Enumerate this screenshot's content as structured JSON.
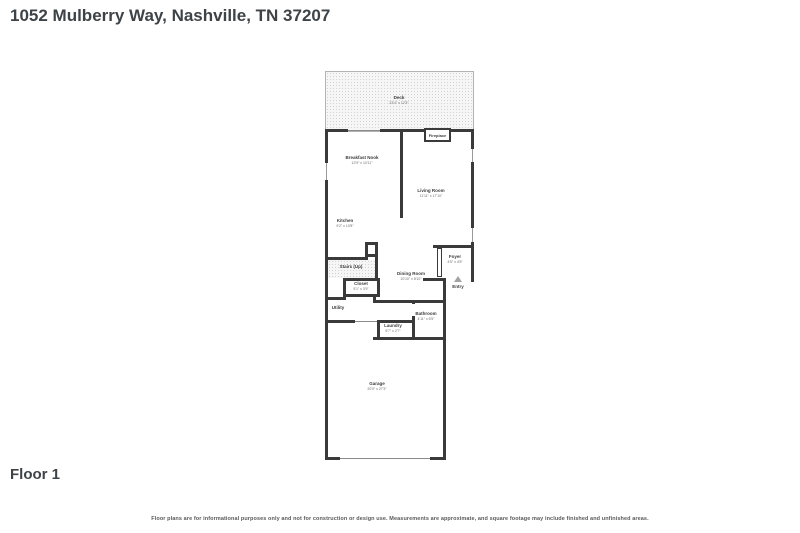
{
  "title": "1052 Mulberry Way, Nashville, TN 37207",
  "floor_label": "Floor 1",
  "disclaimer": "Floor plans are for informational purposes only and not for construction or design use. Measurements are approximate, and square footage may include finished and unfinished areas.",
  "colors": {
    "wall": "#3a3a3a",
    "title_text": "#3e4347",
    "dims_text": "#6b6b6b",
    "entry_marker": "#a3a3a3"
  },
  "rooms": {
    "deck": {
      "name": "Deck",
      "dims": "23'4\" x 12'3\""
    },
    "breakfast_nook": {
      "name": "Breakfast Nook",
      "dims": "12'9\" x 10'11\""
    },
    "living_room": {
      "name": "Living Room",
      "dims": "11'11\" x 17'10\""
    },
    "kitchen": {
      "name": "Kitchen",
      "dims": "9'2\" x 10'8\""
    },
    "stairs": {
      "name": "Stairs (Up)",
      "dims": ""
    },
    "closet": {
      "name": "Closet",
      "dims": "5'1\" x 3'9\""
    },
    "utility": {
      "name": "Utility",
      "dims": ""
    },
    "dining_room": {
      "name": "Dining Room",
      "dims": "10'10\" x 8'10\""
    },
    "foyer": {
      "name": "Foyer",
      "dims": "4'5\" x 4'5\""
    },
    "entry": {
      "name": "Entry",
      "dims": ""
    },
    "bathroom": {
      "name": "Bathroom",
      "dims": "4'11\" x 6'5\""
    },
    "laundry": {
      "name": "Laundry",
      "dims": "5'7\" x 2'7\""
    },
    "garage": {
      "name": "Garage",
      "dims": "20'0\" x 27'3\""
    },
    "fireplace": {
      "name": "Fireplace",
      "dims": ""
    }
  }
}
